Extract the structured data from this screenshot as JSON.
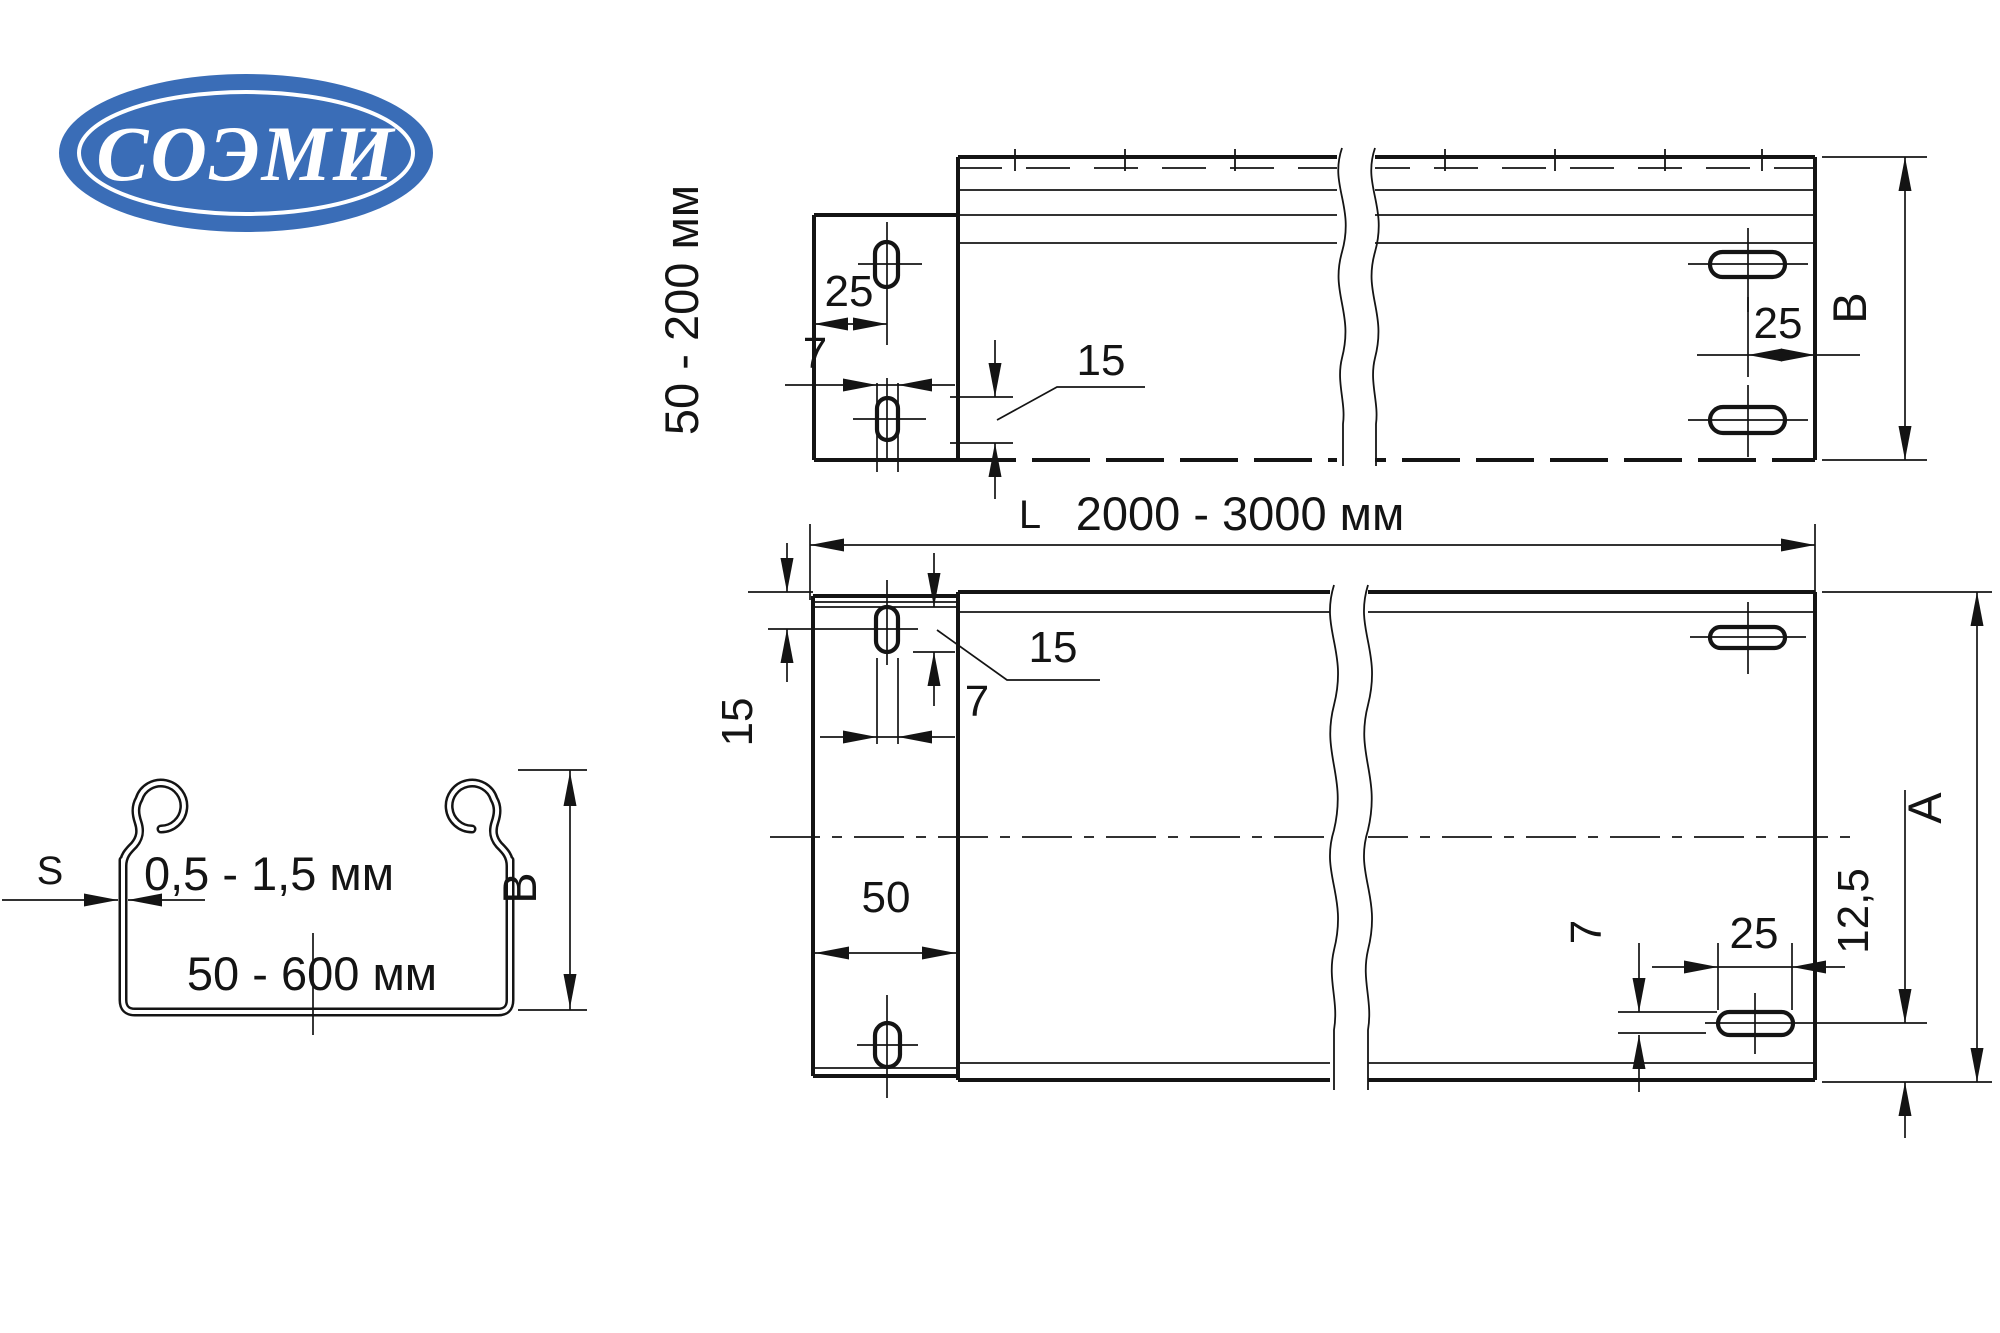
{
  "logo": {
    "text": "СОЭМИ",
    "bg_color": "#3a6db7",
    "ring_color": "#ffffff"
  },
  "line_color": "#141414",
  "side_view": {
    "height_range_label": "50 - 200 мм",
    "dim_25_left": "25",
    "dim_7_left": "7",
    "dim_15_slot": "15",
    "dim_25_right": "25",
    "dim_B": "B"
  },
  "length_dimension": {
    "prefix": "L",
    "value": "2000 - 3000 мм"
  },
  "plan_view": {
    "dim_15_edge": "15",
    "dim_15_slot": "15",
    "dim_7_top": "7",
    "dim_50": "50",
    "dim_7_bottom": "7",
    "dim_25_bottom": "25",
    "dim_12_5": "12,5",
    "dim_A": "A"
  },
  "section_view": {
    "thickness_symbol": "S",
    "thickness_range": "0,5 - 1,5 мм",
    "width_range": "50 - 600 мм",
    "dim_B": "B"
  }
}
